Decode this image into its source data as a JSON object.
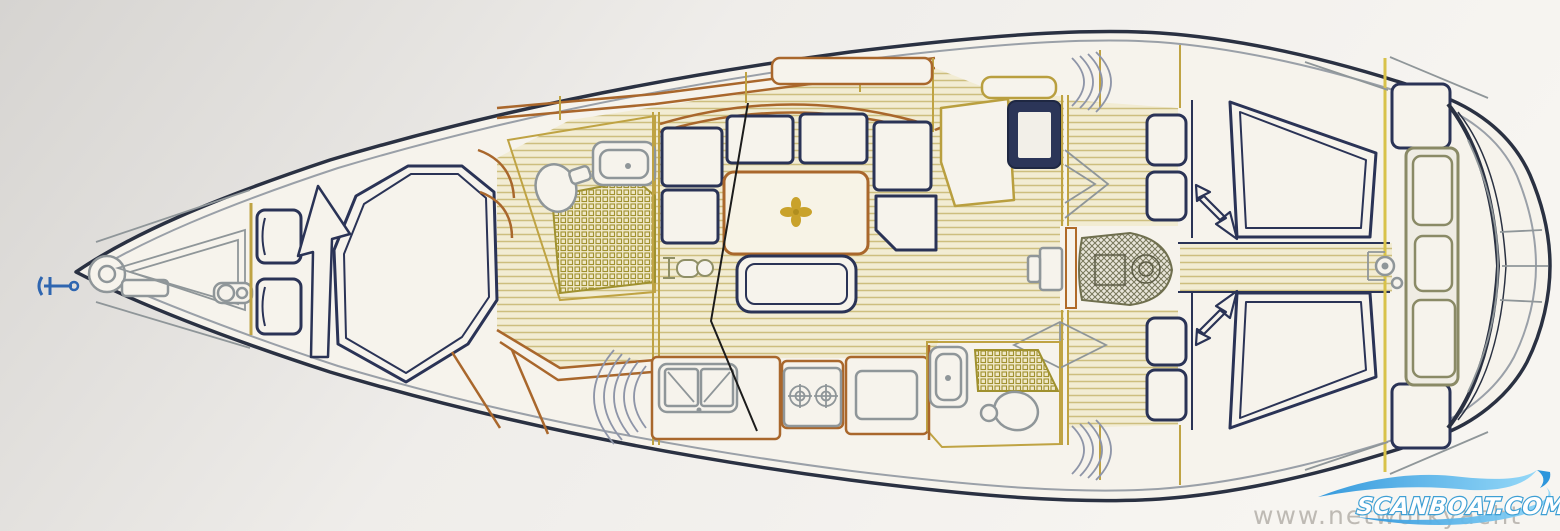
{
  "watermarks": {
    "brand": "SCANBOAT.COM",
    "site": "www.networkyacht"
  },
  "palette": {
    "hull_outline": "#2a3142",
    "deck_line": "#9aa0a8",
    "furniture_navy": "#2a3356",
    "cabinetry_brown": "#a9672c",
    "bulkhead_olive": "#bfa343",
    "wood_floor_line": "#cdbe7e",
    "wood_floor_fill": "#f2ecd3",
    "shower_tile_line": "#a0912f",
    "fixture_gray": "#8f9699",
    "table_emblem_gold": "#c9a22b",
    "anchor_blue": "#2f66b0",
    "logo_blue": "#3aa7e8",
    "watermark_gray": "#b8b4ae",
    "paper": "#f6f3ec"
  },
  "features": [
    "bow-anchor",
    "anchor-windlass",
    "chain-locker",
    "bow-fitting-pump",
    "forward-seats",
    "forward-companionway-arrow",
    "forward-island-berth",
    "forward-head-toilet",
    "forward-head-sink",
    "forward-shower-tray",
    "hanging-locker-doors",
    "saloon-u-settee",
    "saloon-table",
    "table-emblem",
    "saloon-bench",
    "mast-step-fitting",
    "galley-double-sink",
    "galley-stove",
    "galley-fridge",
    "locker-hatching",
    "nav-chart-table",
    "nav-seat",
    "nav-instrument-panel",
    "companionway-steps",
    "engine",
    "aft-head-sink",
    "aft-head-toilet",
    "aft-shower-tray",
    "aft-berth-starboard",
    "aft-berth-port",
    "aft-cabin-arrows",
    "cockpit-benches",
    "transom-lockers",
    "steering-pedestal",
    "swim-platform"
  ]
}
